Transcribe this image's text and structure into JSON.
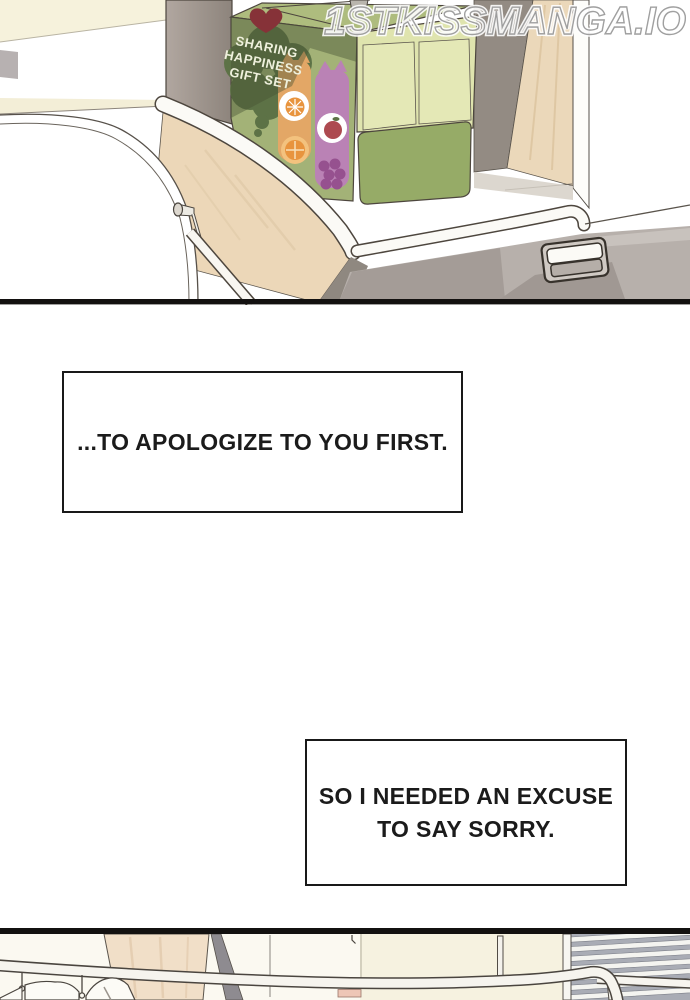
{
  "watermark": {
    "text": "1STKISSMANGA.IO"
  },
  "panel1": {
    "gift_box": {
      "line1": "SHARING",
      "line2": "HAPPINESS",
      "line3": "GIFT SET"
    }
  },
  "narration": {
    "box1": {
      "text": "...TO APOLOGIZE TO YOU FIRST."
    },
    "box2": {
      "line1": "SO I NEEDED AN EXCUSE",
      "line2": "TO SAY SORRY."
    }
  },
  "colors": {
    "panel_border_black": "#131110",
    "cream_wall": "#f6f2dc",
    "wood_light": "#ebd8ba",
    "wood_pink": "#f1dfc8",
    "gray_panel": "#9a9189",
    "box_front_green": "#a3b277",
    "box_side_green": "#dfe4ae",
    "box_compartment_green": "#96ab67",
    "bubble_dark_green": "#5d7246",
    "heart_red": "#863238",
    "orange_bottle": "#e3a766",
    "purple_bottle": "#ba82b5",
    "drawer_gray": "#b7b0ab",
    "blinds_gray": "#a9acb5",
    "watermark_gray": "#9a9a9a"
  }
}
